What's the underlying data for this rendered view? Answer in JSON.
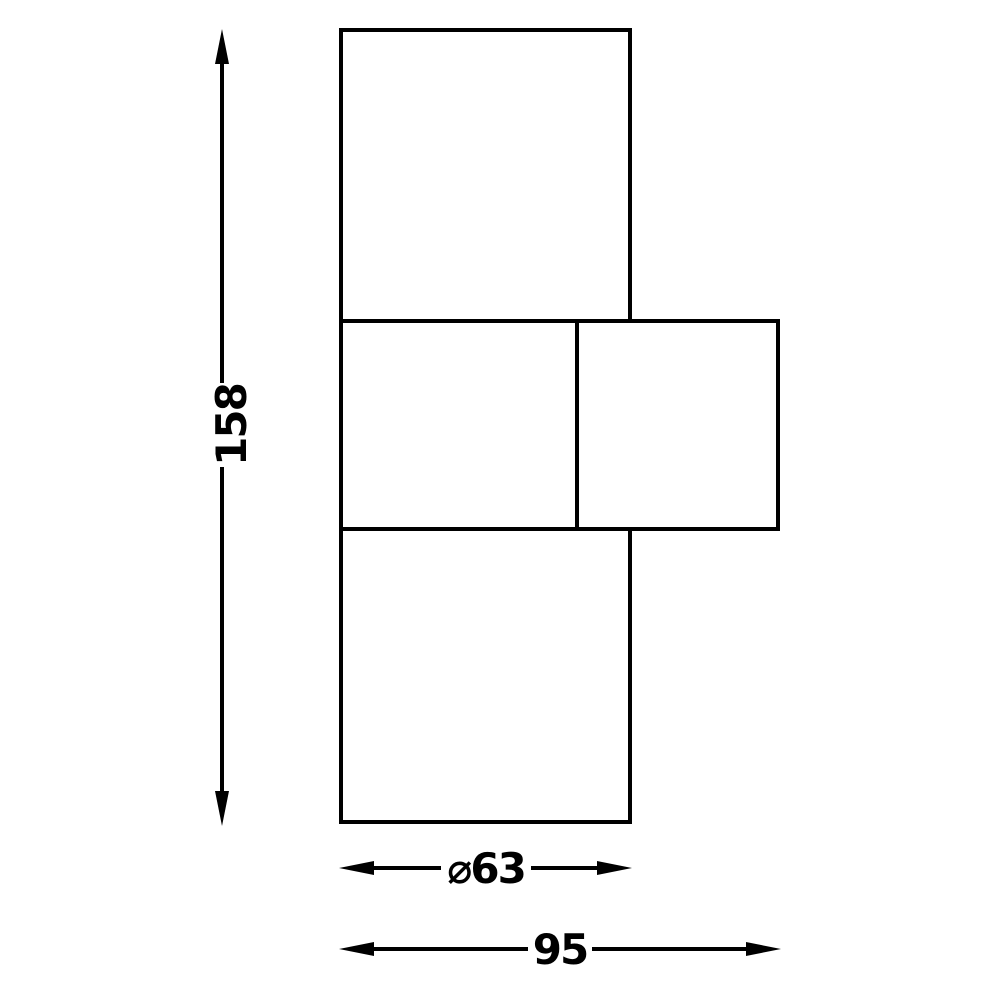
{
  "drawing": {
    "type": "technical-dimension-drawing",
    "background_color": "#ffffff",
    "line_color": "#000000",
    "labels": {
      "height": "158",
      "diameter": "⌀63",
      "width": "95"
    }
  }
}
